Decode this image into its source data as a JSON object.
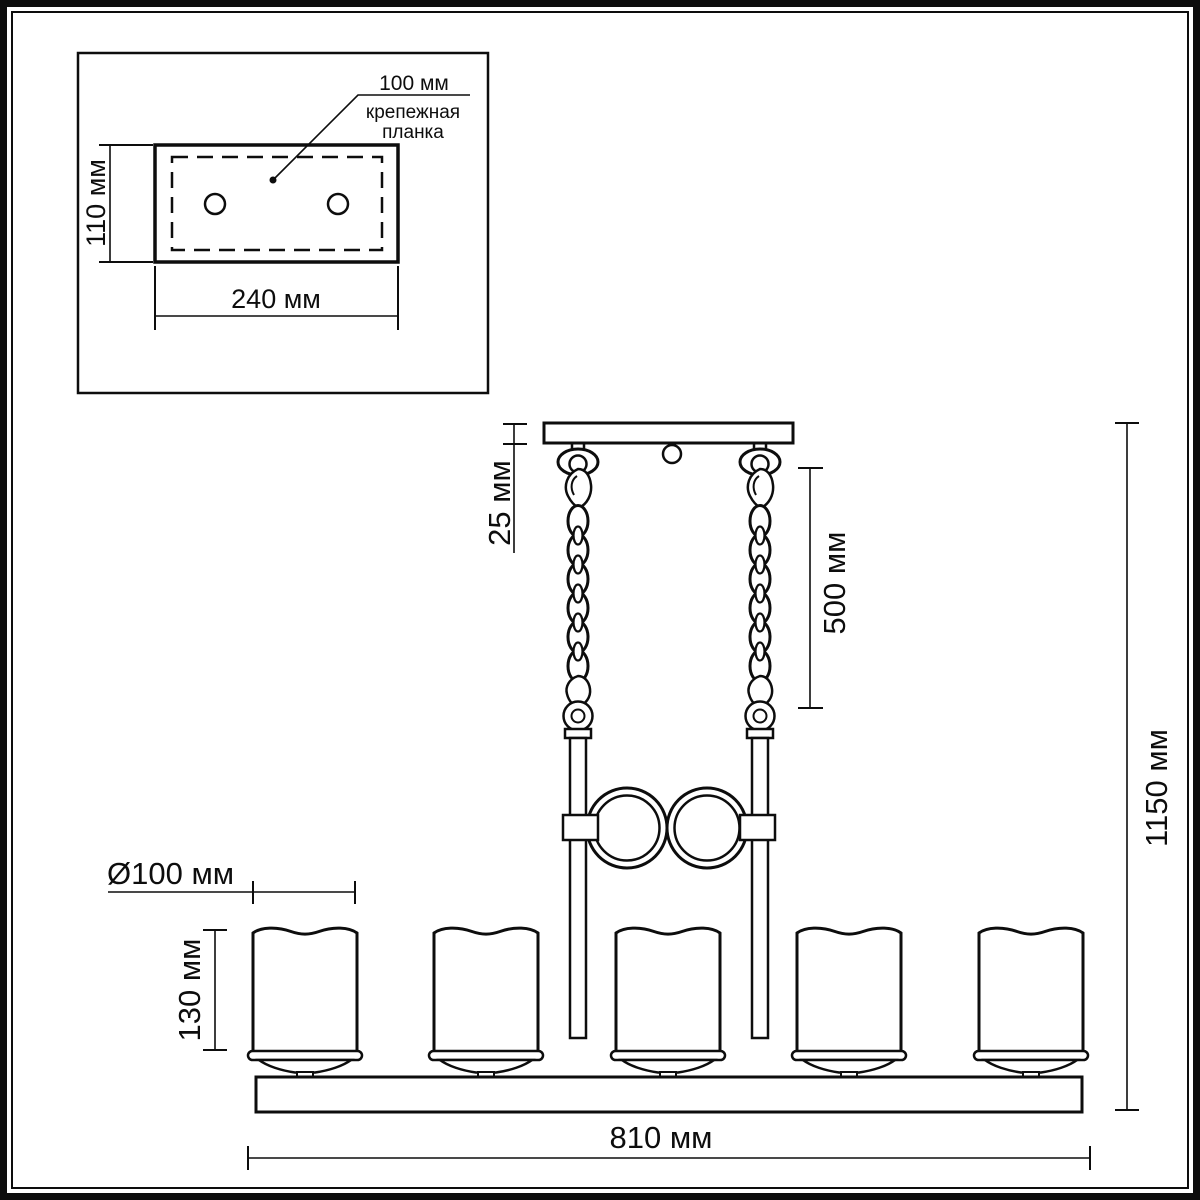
{
  "drawing": {
    "background": "#ffffff",
    "line_color": "#0d0d0d",
    "inset": {
      "leader_value": "100 мм",
      "leader_label_line1": "крепежная",
      "leader_label_line2": "планка",
      "plate_height_dim": "110 мм",
      "plate_width_dim": "240 мм"
    },
    "main": {
      "canopy_height_dim": "25 мм",
      "chain_length_dim": "500 мм",
      "total_height_dim": "1150 мм",
      "shade_diameter_dim": "Ø100 мм",
      "shade_height_dim": "130 мм",
      "bar_length_dim": "810 мм"
    }
  }
}
